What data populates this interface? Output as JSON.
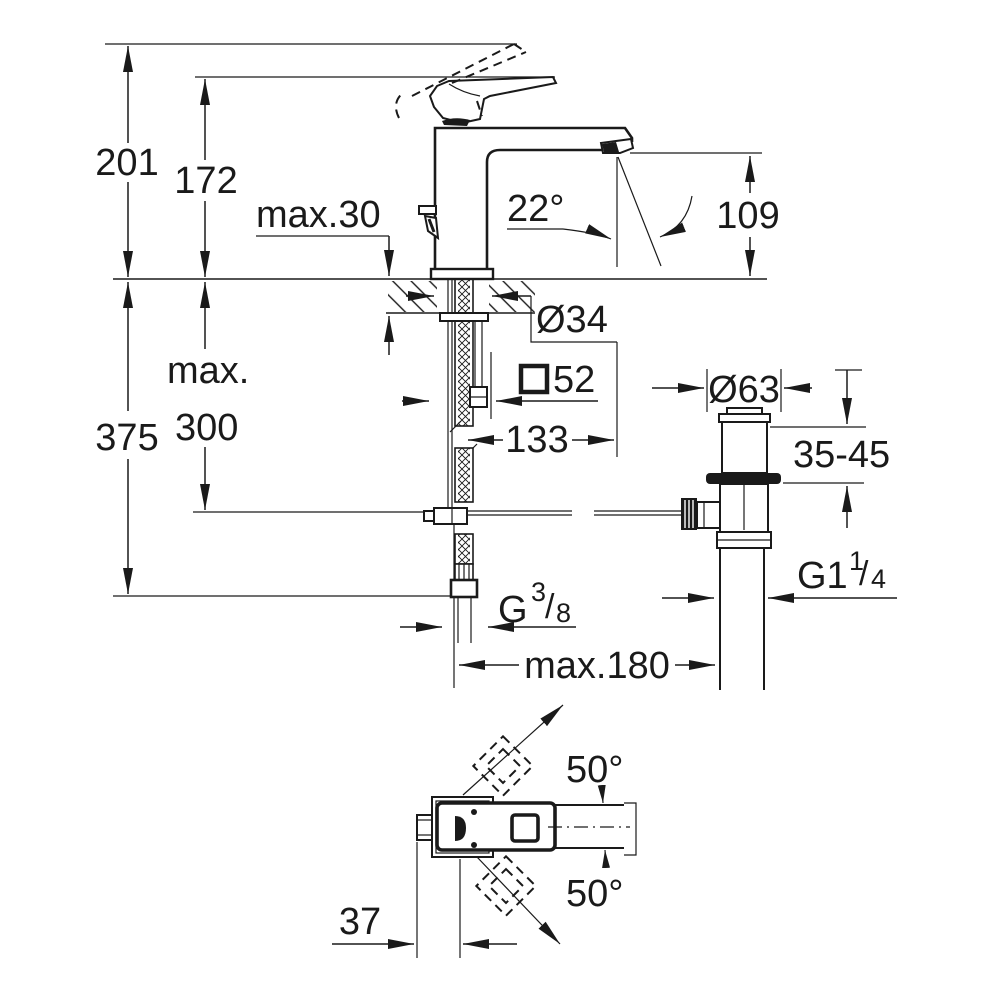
{
  "palette": {
    "ink": "#1a1a1a",
    "background": "#ffffff"
  },
  "side_view": {
    "height_total": "201",
    "height_spout_top": "172",
    "deck_thickness": "max.30",
    "spray_angle": "22°",
    "spout_height": "109",
    "hole_diameter": "Ø34",
    "base_square_symbol": "□",
    "base_square_size": "52",
    "spout_reach": "133",
    "below_deck_max_label": "max.",
    "below_deck_max_value": "300",
    "below_deck_total": "375",
    "supply_thread": {
      "base": "G",
      "numerator": "3",
      "slash": "/",
      "denominator": "8"
    },
    "rod_reach": "max.180"
  },
  "waste_view": {
    "flange_diameter": "Ø63",
    "clamping_range": "35-45",
    "thread": {
      "base": "G1",
      "numerator": "1",
      "slash": "/",
      "denominator": "4"
    }
  },
  "top_view": {
    "swivel_up": "50°",
    "swivel_down": "50°",
    "axis_offset": "37"
  }
}
